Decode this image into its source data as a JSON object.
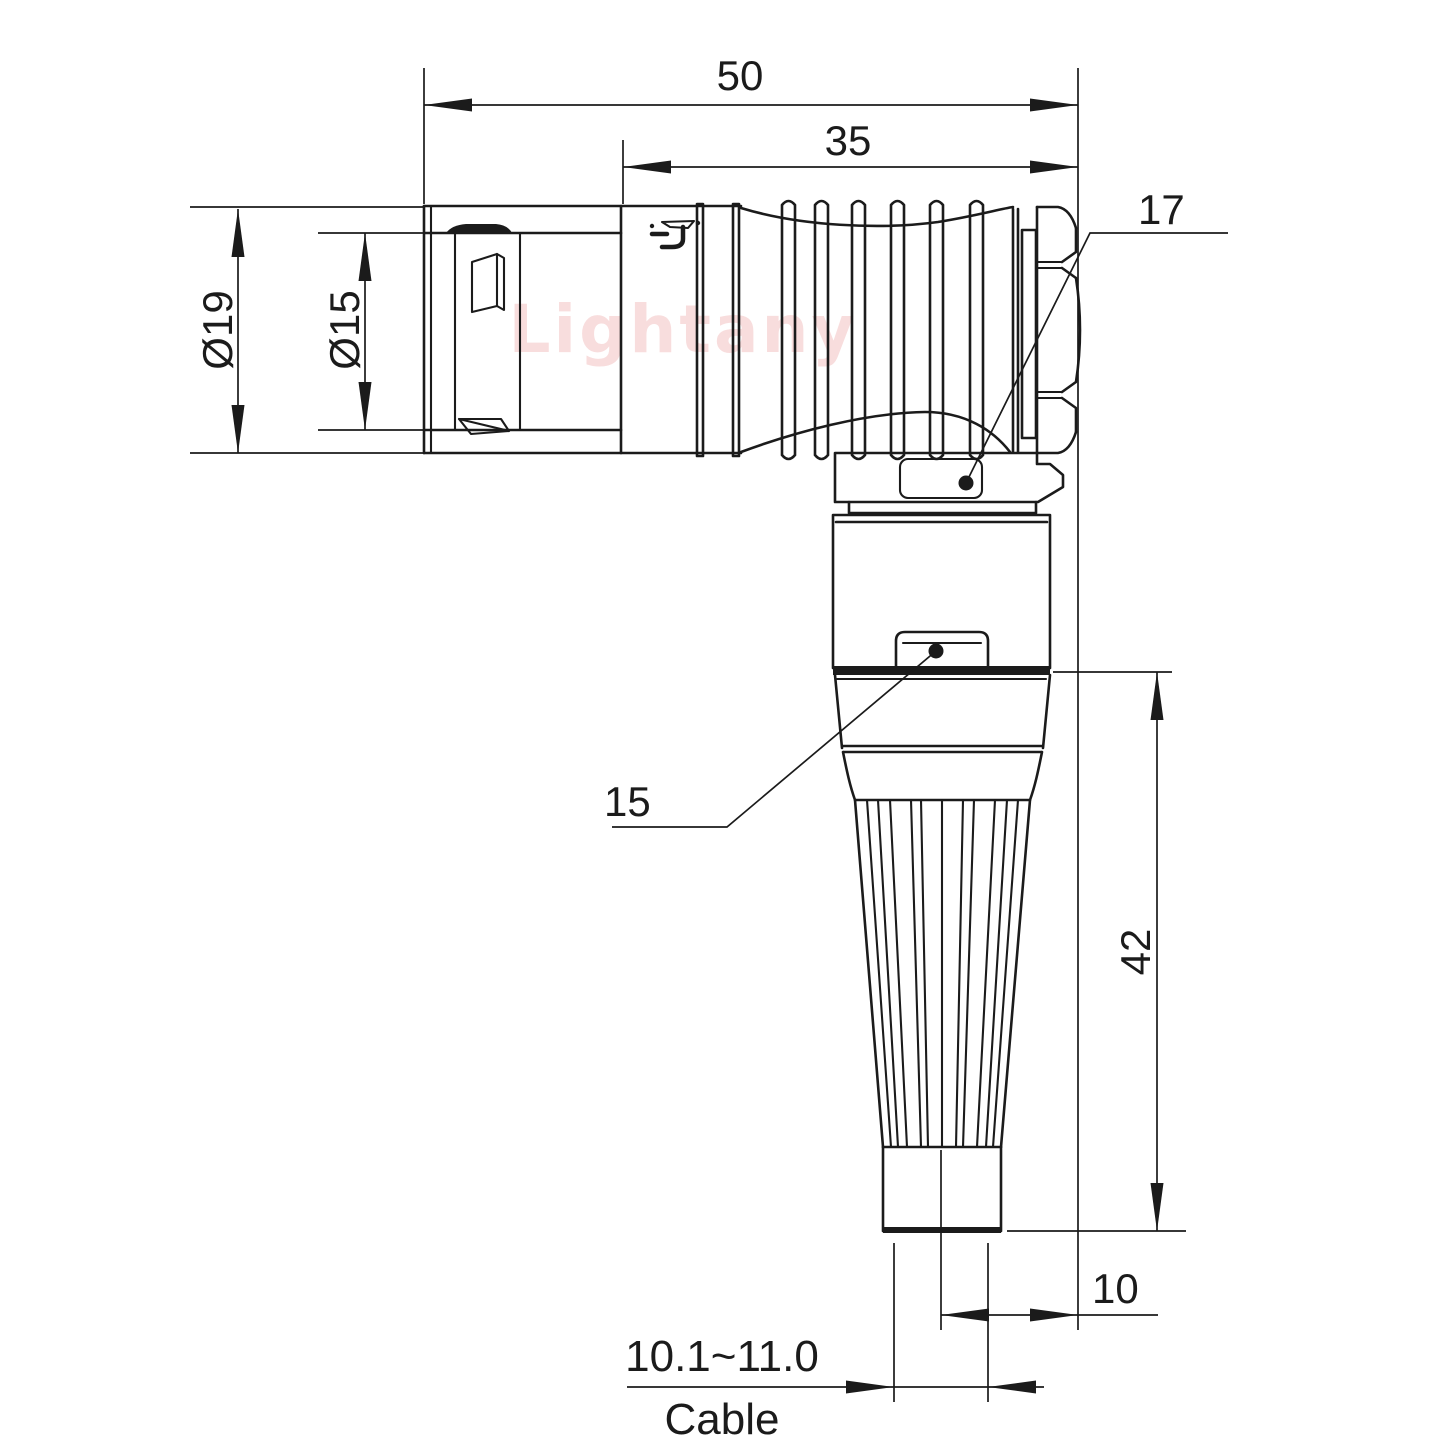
{
  "labels": {
    "overall_length": "50",
    "grip_length": "35",
    "outer_diameter": "Ø19",
    "inner_diameter": "Ø15",
    "nut_callout": "17",
    "latch_callout": "15",
    "elbow_height": "42",
    "cable_offset": "10",
    "cable_diameter_range": "10.1~11.0",
    "cable_label": "Cable"
  },
  "watermark": {
    "text": "Lightany",
    "color": "#f0b4b4"
  },
  "colors": {
    "line": "#1b1b1b",
    "background": "#ffffff"
  }
}
